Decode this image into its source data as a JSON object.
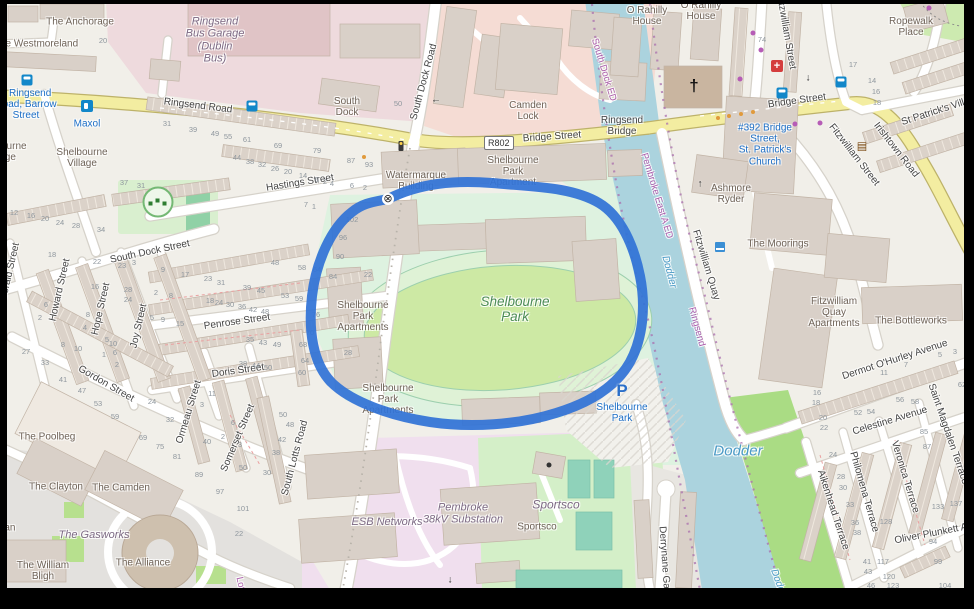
{
  "road_ref_badge": "R802",
  "map_colors": {
    "background": "#f1efe9",
    "water": "#abd3de",
    "route_highlight": "#3173d6",
    "major_road": "#f3eda1",
    "industrial_pink": "#eedadd",
    "esb_pink": "#f0dfee",
    "stadium_green": "#def2e0",
    "field_green": "#cde9a4",
    "sports_green": "#d4efc8",
    "court_teal": "#8fd2ba",
    "riverside_green": "#aadc84",
    "building": "#d9d0c8",
    "poi_blue": "#1b6ec7",
    "admin_purple": "#ad5fad"
  },
  "labels": {
    "streets": [
      {
        "t": "Ringsend Road",
        "x": 198,
        "y": 106,
        "r": 7
      },
      {
        "t": "Bridge Street",
        "x": 552,
        "y": 137,
        "r": -4
      },
      {
        "t": "Ringsend\nBridge",
        "x": 622,
        "y": 126,
        "r": 0
      },
      {
        "t": "Bridge Street",
        "x": 797,
        "y": 101,
        "r": -8
      },
      {
        "t": "Irishtown Road",
        "x": 896,
        "y": 150,
        "r": 52
      },
      {
        "t": "St Patrick's Villas",
        "x": 938,
        "y": 111,
        "r": -18
      },
      {
        "t": "Fitzwilliam Street",
        "x": 786,
        "y": 32,
        "r": 80
      },
      {
        "t": "Fitzwilliam Street",
        "x": 854,
        "y": 155,
        "r": 52
      },
      {
        "t": "South Dock Road",
        "x": 424,
        "y": 82,
        "r": -75
      },
      {
        "t": "Hastings Street",
        "x": 300,
        "y": 183,
        "r": -9
      },
      {
        "t": "South Dock Street",
        "x": 150,
        "y": 252,
        "r": -12
      },
      {
        "t": "Penrose Street",
        "x": 237,
        "y": 322,
        "r": -8
      },
      {
        "t": "Doris Street",
        "x": 238,
        "y": 371,
        "r": -8
      },
      {
        "t": "Gordon Street",
        "x": 106,
        "y": 384,
        "r": 30
      },
      {
        "t": "Howard Street",
        "x": 60,
        "y": 290,
        "r": -77
      },
      {
        "t": "Hope Street",
        "x": 101,
        "y": 309,
        "r": -77
      },
      {
        "t": "Joy Street",
        "x": 139,
        "y": 326,
        "r": -77
      },
      {
        "t": "Ormeau Street",
        "x": 189,
        "y": 412,
        "r": -73
      },
      {
        "t": "Somerset Street",
        "x": 238,
        "y": 438,
        "r": -67
      },
      {
        "t": "South Lotts Road",
        "x": 295,
        "y": 458,
        "r": -75
      },
      {
        "t": "Gerald Street",
        "x": 10,
        "y": 272,
        "r": -77
      },
      {
        "t": "Fitzwilliam Quay",
        "x": 706,
        "y": 265,
        "r": 73
      },
      {
        "t": "Dermot O'Hurley Avenue",
        "x": 895,
        "y": 360,
        "r": -18
      },
      {
        "t": "Celestine Avenue",
        "x": 890,
        "y": 421,
        "r": -17
      },
      {
        "t": "Aikenhead Terrace",
        "x": 833,
        "y": 510,
        "r": 72
      },
      {
        "t": "Philomena Terrace",
        "x": 864,
        "y": 492,
        "r": 74
      },
      {
        "t": "Veronica Terrace",
        "x": 905,
        "y": 477,
        "r": 73
      },
      {
        "t": "Saint Magdalen Terrace",
        "x": 948,
        "y": 434,
        "r": 71
      },
      {
        "t": "Oliver Plunkett Ave",
        "x": 936,
        "y": 533,
        "r": -11
      },
      {
        "t": "Derrynane Gardens",
        "x": 665,
        "y": 570,
        "r": 86
      }
    ],
    "places": [
      {
        "t": "The Anchorage",
        "x": 80,
        "y": 22
      },
      {
        "t": "The Westmoreland",
        "x": 36,
        "y": 44
      },
      {
        "t": "South\nDock",
        "x": 347,
        "y": 107
      },
      {
        "t": "Camden\nLock",
        "x": 528,
        "y": 111
      },
      {
        "t": "Shelbourne\nVillage",
        "x": 82,
        "y": 158
      },
      {
        "t": "Shelbourne\nVillage",
        "x": 1,
        "y": 152
      },
      {
        "t": "O Rahilly\nHouse",
        "x": 647,
        "y": 16
      },
      {
        "t": "O Rahilly\nHouse",
        "x": 701,
        "y": 11
      },
      {
        "t": "Ropewalk\nPlace",
        "x": 911,
        "y": 27
      },
      {
        "t": "Watermarque\nBuilding",
        "x": 416,
        "y": 181
      },
      {
        "t": "Shelbourne\nPark\nApartment",
        "x": 513,
        "y": 172
      },
      {
        "t": "Shelbourne\nPark\nApartments",
        "x": 363,
        "y": 317
      },
      {
        "t": "Shelbourne\nPark\nApartments",
        "x": 388,
        "y": 400
      },
      {
        "t": "Ashmore\nRyder",
        "x": 731,
        "y": 194
      },
      {
        "t": "The Moorings",
        "x": 778,
        "y": 244
      },
      {
        "t": "Fitzwilliam\nQuay\nApartments",
        "x": 834,
        "y": 313
      },
      {
        "t": "The Bottleworks",
        "x": 911,
        "y": 321
      },
      {
        "t": "The Poolbeg",
        "x": 47,
        "y": 437
      },
      {
        "t": "The Clayton",
        "x": 56,
        "y": 487
      },
      {
        "t": "The Camden",
        "x": 121,
        "y": 488
      },
      {
        "t": "The William\nBligh",
        "x": 43,
        "y": 571
      },
      {
        "t": "The Alliance",
        "x": 143,
        "y": 563
      },
      {
        "t": "nian",
        "x": 6,
        "y": 528
      },
      {
        "t": "Sportsco",
        "x": 537,
        "y": 527
      }
    ],
    "industrial": [
      {
        "t": "Ringsend\nBus Garage\n(Dublin\nBus)",
        "x": 215,
        "y": 40
      },
      {
        "t": "ESB Networks",
        "x": 387,
        "y": 522
      },
      {
        "t": "Pembroke\n38kV Substation",
        "x": 463,
        "y": 514
      },
      {
        "t": "Sportsco",
        "x": 556,
        "y": 505,
        "s": 12
      },
      {
        "t": "The Gasworks",
        "x": 94,
        "y": 535
      }
    ],
    "stadium": [
      {
        "t": "Shelbourne\nPark",
        "x": 515,
        "y": 309
      }
    ],
    "water": [
      {
        "t": "Dodder",
        "x": 738,
        "y": 452,
        "s": 15
      },
      {
        "t": "Dodder",
        "x": 669,
        "y": 272,
        "r": 75,
        "s": 10
      },
      {
        "t": "Dodder",
        "x": 779,
        "y": 585,
        "r": 70,
        "s": 10
      }
    ],
    "admin": [
      {
        "t": "South Dock ED",
        "x": 603,
        "y": 70,
        "r": 73
      },
      {
        "t": "Pembroke East A ED",
        "x": 656,
        "y": 196,
        "r": 73
      },
      {
        "t": "Ringsend",
        "x": 696,
        "y": 327,
        "r": 75
      },
      {
        "t": "Lots",
        "x": 240,
        "y": 586,
        "r": 78
      }
    ],
    "poi_blue": [
      {
        "t": "5 Ringsend\nRoad, Barrow\nStreet",
        "x": 26,
        "y": 105
      },
      {
        "t": "Maxol",
        "x": 87,
        "y": 124
      },
      {
        "t": "#392 Bridge\nStreet,\nSt. Patrick's\nChurch",
        "x": 765,
        "y": 145
      },
      {
        "t": "Shelbourne\nPark",
        "x": 622,
        "y": 413
      }
    ],
    "house_numbers": [
      [
        "20",
        103,
        41
      ],
      [
        "31",
        167,
        124
      ],
      [
        "39",
        193,
        130
      ],
      [
        "49",
        215,
        134
      ],
      [
        "55",
        228,
        137
      ],
      [
        "61",
        247,
        140
      ],
      [
        "69",
        278,
        146
      ],
      [
        "79",
        317,
        151
      ],
      [
        "87",
        351,
        161
      ],
      [
        "93",
        369,
        165
      ],
      [
        "44",
        237,
        158
      ],
      [
        "38",
        250,
        162
      ],
      [
        "32",
        262,
        165
      ],
      [
        "26",
        275,
        169
      ],
      [
        "20",
        288,
        172
      ],
      [
        "14",
        303,
        176
      ],
      [
        "6",
        317,
        180
      ],
      [
        "2",
        325,
        182
      ],
      [
        "37",
        124,
        183
      ],
      [
        "31",
        141,
        186
      ],
      [
        "50",
        398,
        104
      ],
      [
        "4",
        332,
        184
      ],
      [
        "6",
        352,
        186
      ],
      [
        "2",
        365,
        188
      ],
      [
        "7",
        306,
        205
      ],
      [
        "1",
        314,
        207
      ],
      [
        "102",
        352,
        220
      ],
      [
        "96",
        343,
        238
      ],
      [
        "90",
        340,
        257
      ],
      [
        "84",
        333,
        277
      ],
      [
        "64",
        317,
        270
      ],
      [
        "22",
        368,
        275
      ],
      [
        "76",
        316,
        315
      ],
      [
        "70",
        310,
        333
      ],
      [
        "68",
        303,
        345
      ],
      [
        "64",
        305,
        361
      ],
      [
        "60",
        302,
        373
      ],
      [
        "28",
        348,
        353
      ],
      [
        "12",
        14,
        213
      ],
      [
        "16",
        31,
        216
      ],
      [
        "20",
        45,
        219
      ],
      [
        "24",
        60,
        223
      ],
      [
        "28",
        76,
        226
      ],
      [
        "34",
        101,
        230
      ],
      [
        "18",
        52,
        255
      ],
      [
        "22",
        97,
        262
      ],
      [
        "3",
        134,
        263
      ],
      [
        "23",
        122,
        266
      ],
      [
        "16",
        95,
        287
      ],
      [
        "28",
        128,
        290
      ],
      [
        "24",
        128,
        300
      ],
      [
        "9",
        163,
        270
      ],
      [
        "17",
        185,
        275
      ],
      [
        "23",
        208,
        279
      ],
      [
        "31",
        221,
        283
      ],
      [
        "39",
        247,
        288
      ],
      [
        "45",
        261,
        291
      ],
      [
        "53",
        285,
        296
      ],
      [
        "59",
        299,
        299
      ],
      [
        "2",
        156,
        293
      ],
      [
        "8",
        171,
        296
      ],
      [
        "18",
        210,
        301
      ],
      [
        "24",
        219,
        303
      ],
      [
        "30",
        230,
        305
      ],
      [
        "36",
        242,
        307
      ],
      [
        "42",
        253,
        310
      ],
      [
        "48",
        265,
        312
      ],
      [
        "48",
        275,
        263
      ],
      [
        "58",
        302,
        268
      ],
      [
        "5",
        152,
        318
      ],
      [
        "9",
        163,
        320
      ],
      [
        "15",
        180,
        324
      ],
      [
        "8",
        88,
        315
      ],
      [
        "4",
        85,
        328
      ],
      [
        "6",
        46,
        305
      ],
      [
        "2",
        40,
        318
      ],
      [
        "5",
        107,
        340
      ],
      [
        "10",
        113,
        344
      ],
      [
        "1",
        104,
        355
      ],
      [
        "6",
        115,
        353
      ],
      [
        "2",
        117,
        365
      ],
      [
        "8",
        63,
        345
      ],
      [
        "10",
        78,
        349
      ],
      [
        "27",
        26,
        352
      ],
      [
        "33",
        45,
        363
      ],
      [
        "41",
        63,
        380
      ],
      [
        "47",
        82,
        391
      ],
      [
        "53",
        98,
        404
      ],
      [
        "59",
        115,
        417
      ],
      [
        "69",
        143,
        438
      ],
      [
        "75",
        160,
        447
      ],
      [
        "81",
        177,
        457
      ],
      [
        "89",
        199,
        475
      ],
      [
        "97",
        220,
        492
      ],
      [
        "101",
        243,
        509
      ],
      [
        "22",
        239,
        534
      ],
      [
        "24",
        152,
        402
      ],
      [
        "32",
        170,
        420
      ],
      [
        "40",
        207,
        442
      ],
      [
        "2",
        223,
        437
      ],
      [
        "50",
        243,
        468
      ],
      [
        "3",
        202,
        405
      ],
      [
        "11",
        212,
        394
      ],
      [
        "6",
        233,
        423
      ],
      [
        "3",
        240,
        445
      ],
      [
        "35",
        250,
        340
      ],
      [
        "43",
        263,
        343
      ],
      [
        "49",
        277,
        345
      ],
      [
        "38",
        243,
        364
      ],
      [
        "44",
        256,
        366
      ],
      [
        "50",
        268,
        368
      ],
      [
        "50",
        283,
        415
      ],
      [
        "48",
        290,
        425
      ],
      [
        "42",
        282,
        440
      ],
      [
        "38",
        276,
        453
      ],
      [
        "30",
        267,
        473
      ],
      [
        "74",
        762,
        40
      ],
      [
        "17",
        853,
        65
      ],
      [
        "14",
        872,
        81
      ],
      [
        "16",
        876,
        92
      ],
      [
        "18",
        877,
        103
      ],
      [
        "16",
        817,
        393
      ],
      [
        "18",
        816,
        403
      ],
      [
        "20",
        823,
        418
      ],
      [
        "22",
        824,
        428
      ],
      [
        "24",
        833,
        455
      ],
      [
        "28",
        841,
        477
      ],
      [
        "30",
        843,
        488
      ],
      [
        "33",
        850,
        505
      ],
      [
        "36",
        855,
        523
      ],
      [
        "38",
        857,
        533
      ],
      [
        "41",
        867,
        562
      ],
      [
        "43",
        868,
        572
      ],
      [
        "46",
        871,
        586
      ],
      [
        "52",
        858,
        413
      ],
      [
        "54",
        871,
        412
      ],
      [
        "56",
        900,
        400
      ],
      [
        "58",
        915,
        402
      ],
      [
        "62",
        962,
        385
      ],
      [
        "85",
        924,
        432
      ],
      [
        "87",
        927,
        447
      ],
      [
        "11",
        884,
        373
      ],
      [
        "7",
        906,
        365
      ],
      [
        "5",
        940,
        355
      ],
      [
        "3",
        955,
        352
      ],
      [
        "128",
        886,
        522
      ],
      [
        "133",
        938,
        507
      ],
      [
        "137",
        956,
        504
      ],
      [
        "117",
        883,
        562
      ],
      [
        "120",
        889,
        577
      ],
      [
        "123",
        893,
        586
      ],
      [
        "94",
        933,
        542
      ],
      [
        "99",
        938,
        562
      ],
      [
        "104",
        945,
        586
      ]
    ]
  },
  "icons": [
    {
      "n": "bus-stop-icon",
      "x": 27,
      "y": 80
    },
    {
      "n": "bus-stop-icon",
      "x": 252,
      "y": 106
    },
    {
      "n": "bus-stop-icon",
      "x": 782,
      "y": 93
    },
    {
      "n": "bus-stop-icon",
      "x": 841,
      "y": 82
    },
    {
      "n": "fuel-icon",
      "x": 87,
      "y": 106
    },
    {
      "n": "traffic-signals-icon",
      "x": 401,
      "y": 146
    },
    {
      "n": "gate-icon",
      "x": 388,
      "y": 199,
      "g": "⊗"
    },
    {
      "n": "church-icon",
      "x": 694,
      "y": 86,
      "g": "†"
    },
    {
      "n": "pharmacy-icon",
      "x": 777,
      "y": 66,
      "g": "+"
    },
    {
      "n": "library-icon",
      "x": 862,
      "y": 146,
      "g": "▤"
    },
    {
      "n": "parking-icon",
      "x": 622,
      "y": 391,
      "g": "P"
    },
    {
      "n": "playground-icon",
      "x": 158,
      "y": 202
    },
    {
      "n": "slipway-icon",
      "x": 720,
      "y": 247
    },
    {
      "n": "arrow-icon",
      "x": 436,
      "y": 100,
      "g": "←"
    },
    {
      "n": "arrow-icon",
      "x": 808,
      "y": 78,
      "g": "↓"
    },
    {
      "n": "arrow-icon",
      "x": 450,
      "y": 580,
      "g": "↓"
    },
    {
      "n": "arrow-icon",
      "x": 700,
      "y": 184,
      "g": "↑"
    },
    {
      "n": "dot-black-icon",
      "x": 549,
      "y": 465
    },
    {
      "n": "shop-dot-icon",
      "x": 753,
      "y": 33
    },
    {
      "n": "shop-dot-icon",
      "x": 761,
      "y": 50
    },
    {
      "n": "shop-dot-icon",
      "x": 740,
      "y": 79
    },
    {
      "n": "shop-dot-icon",
      "x": 795,
      "y": 124
    },
    {
      "n": "shop-dot-icon",
      "x": 820,
      "y": 123
    },
    {
      "n": "shop-dot-icon",
      "x": 929,
      "y": 8
    },
    {
      "n": "lamp-dot-icon",
      "x": 718,
      "y": 118
    },
    {
      "n": "lamp-dot-icon",
      "x": 729,
      "y": 116
    },
    {
      "n": "lamp-dot-icon",
      "x": 741,
      "y": 114
    },
    {
      "n": "lamp-dot-icon",
      "x": 753,
      "y": 112
    },
    {
      "n": "lamp-dot-icon",
      "x": 364,
      "y": 157
    }
  ]
}
